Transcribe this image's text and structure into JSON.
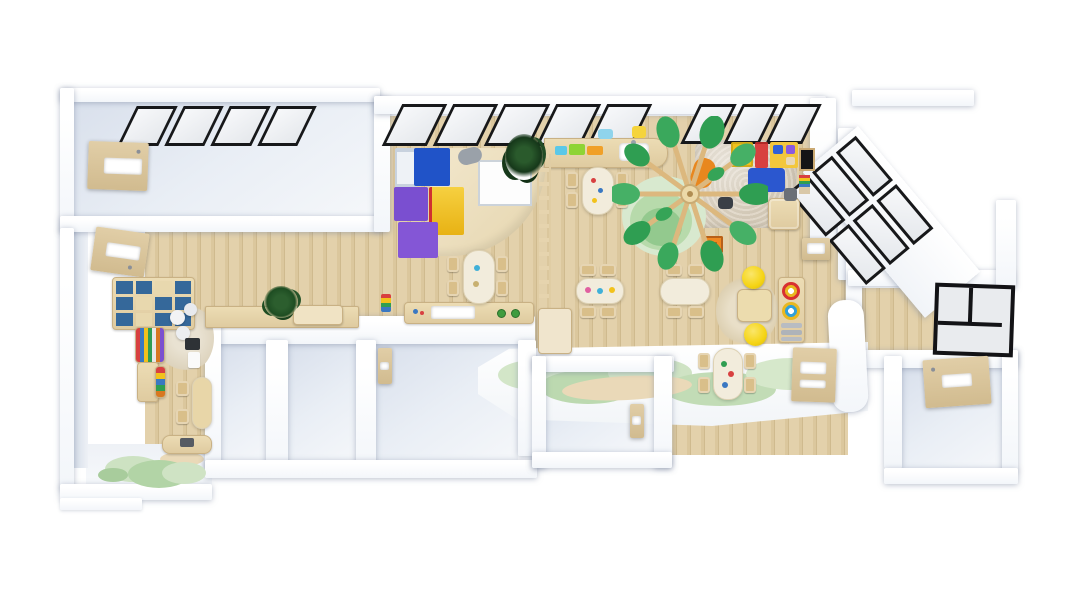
{
  "meta": {
    "title": "Kindergarten interior — 3D top-down floor plan render",
    "view": "top-down axonometric",
    "background": "#ffffff"
  },
  "palette": {
    "bg": "#ffffff",
    "wood": "#dcc89e",
    "chairTan": "#d9bf8a",
    "tableCream": "#f2ecdc",
    "stoolYellow": "#f5d414",
    "cubbyBlue": "#35689a",
    "matBlue": "#2b57cf",
    "blockBlue": "#2053c8",
    "blockPurple": "#7a4fd0",
    "blockYellow": "#f2c21c",
    "blockRed": "#d84040",
    "treeLeaf": "#2f9e52",
    "treeLeafLight": "#46b066",
    "doorWood": "#d8c49c",
    "frame": "#17181a"
  },
  "scene": {
    "rooms": [
      {
        "id": "corridor-nw",
        "label": "corridor with ceiling skylights",
        "floor": "white",
        "features": [
          "4 slanted black-framed skylight panels",
          "wooden door with blank white sign"
        ]
      },
      {
        "id": "reading-room-w",
        "label": "reading and play room",
        "floor": "wood",
        "features": [
          "cubby shelf with blue bins",
          "book display rack",
          "storage cabinet",
          "round woven rug with white poufs",
          "kids table with 2 chairs",
          "bench",
          "lily-pad green rug",
          "potted plant",
          "low cabinet counter with beige box"
        ]
      },
      {
        "id": "main-classroom",
        "label": "main activity classroom",
        "floor": "wood",
        "features": [
          "black-framed window wall (2 groups)",
          "soft-play climbing corner (blue/purple cubes, yellow slide, stepped platform)",
          "white play mat",
          "dark potted plant",
          "wall counter with colored trays and sink",
          "6 activity tables with toddler chairs",
          "hanging ladder divider",
          "south sink counter with faucets",
          "play tree with wooden spokes and green leaves",
          "tiered green round platform",
          "shaggy beige rug with soft blocks",
          "blue floor mat",
          "orange beanbag",
          "wall chalkboard",
          "wall activity panel",
          "square wood cabinet",
          "orange puzzle table",
          "jute round rug with square table",
          "2 yellow stools",
          "rainbow-stacker shelf"
        ]
      },
      {
        "id": "washroom-1",
        "label": "small white room",
        "floor": "white"
      },
      {
        "id": "washroom-2",
        "label": "small white room",
        "floor": "white"
      },
      {
        "id": "washroom-3",
        "label": "small white room with door sign",
        "floor": "white"
      },
      {
        "id": "washroom-4",
        "label": "small white room with door sign",
        "floor": "white"
      },
      {
        "id": "south-platform",
        "label": "white platform with pastel green blob rug and pill table",
        "floor": "white"
      },
      {
        "id": "sunroom-e",
        "label": "sunroom with diagonal black-framed skylight wall",
        "floor": "wood"
      },
      {
        "id": "side-room-e",
        "label": "east room with black glass partition",
        "floor": "wood"
      },
      {
        "id": "entry-room-se",
        "label": "south-east room with wooden door sign",
        "floor": "white"
      }
    ],
    "furniture_counts": {
      "activity_tables": 7,
      "toddler_chairs": 22,
      "yellow_stools": 2,
      "wooden_doors_with_signs": 5,
      "skylight_pane_groups": 3,
      "plants": 2
    }
  }
}
